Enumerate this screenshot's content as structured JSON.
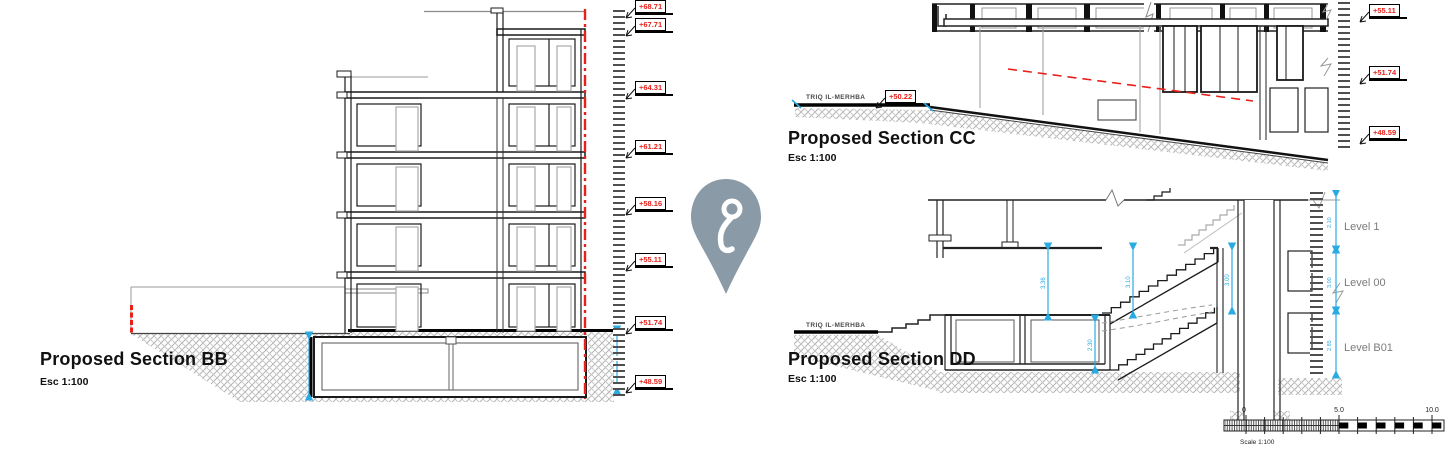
{
  "sections": {
    "bb": {
      "title": "Proposed Section BB",
      "scale": "Esc 1:100"
    },
    "cc": {
      "title": "Proposed Section CC",
      "scale": "Esc 1:100",
      "street_label": "TRIQ IL-MERHBA",
      "street_elevation": "+50.22"
    },
    "dd": {
      "title": "Proposed Section DD",
      "scale": "Esc 1:100",
      "street_label": "TRIQ IL-MERHBA"
    }
  },
  "elevation_markers_left": [
    "+68.71",
    "+67.71",
    "+64.31",
    "+61.21",
    "+58.16",
    "+55.11",
    "+51.74",
    "+48.59"
  ],
  "elevation_markers_right": [
    "+55.11",
    "+51.74",
    "+48.59"
  ],
  "level_labels": [
    "Level 1",
    "Level 00",
    "Level B01"
  ],
  "dd_dimensions": [
    "3.36",
    "3.10",
    "3.00",
    "2.30"
  ],
  "dd_ruler_dimensions": [
    "2.10",
    "3.00",
    "2.85"
  ],
  "scale_bar": {
    "tick_0": "0",
    "tick_5": "5.0",
    "tick_10": "10.0",
    "label": "Scale 1:100"
  },
  "colors": {
    "marker_red": "#e8201a",
    "dimension_cyan": "#29abe2",
    "pin_gray": "#8a9aa7",
    "level_text_gray": "#7b7b7b"
  }
}
